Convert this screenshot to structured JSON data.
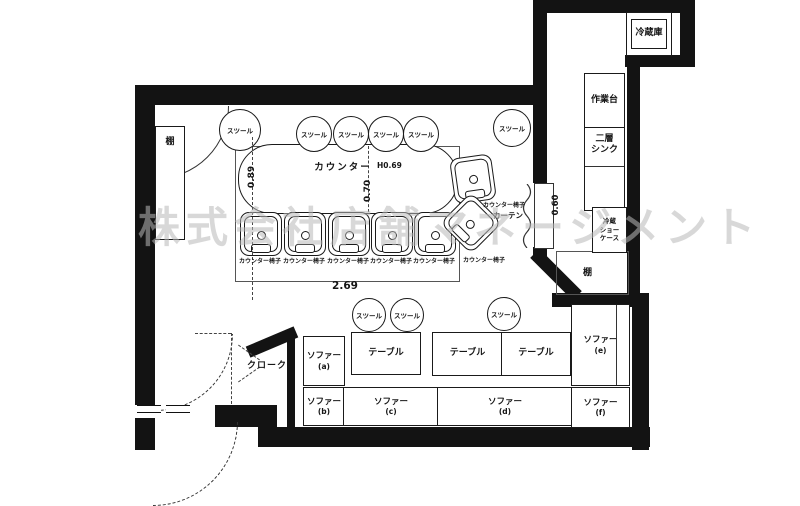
{
  "watermark": "株式会社店舗マネージメント",
  "kitchen": {
    "refrigerator": "冷蔵庫",
    "work_table": "作業台",
    "sink_line1": "二層",
    "sink_line2": "シンク",
    "showcase_line1": "冷蔵",
    "showcase_line2": "ショー",
    "showcase_line3": "ケース",
    "shelf": "棚"
  },
  "main_room": {
    "counter": "カウンター",
    "counter_height": "H0.69",
    "stool": "スツール",
    "counter_chair": "カウンター椅子",
    "curtain": "カーテン",
    "shelf": "棚",
    "dim_depth": "0.89",
    "dim_mid": "0.70",
    "dim_length": "2.69",
    "dim_door": "0.60"
  },
  "lounge": {
    "cloak": "クローク",
    "table": "テーブル",
    "stool": "スツール",
    "sofas": [
      {
        "name": "ソファー",
        "tag": "(a)"
      },
      {
        "name": "ソファー",
        "tag": "(b)"
      },
      {
        "name": "ソファー",
        "tag": "(c)"
      },
      {
        "name": "ソファー",
        "tag": "(d)"
      },
      {
        "name": "ソファー",
        "tag": "(e)"
      },
      {
        "name": "ソファー",
        "tag": "(f)"
      }
    ]
  },
  "colors": {
    "wall": "#131313",
    "line": "#555555",
    "watermark": "#b9b9b9"
  }
}
